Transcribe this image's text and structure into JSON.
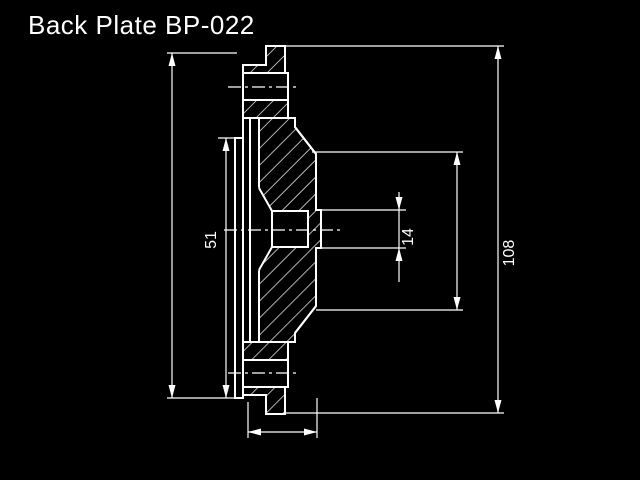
{
  "title": "Back Plate BP-022",
  "labels": {
    "rim_width": "51",
    "boss_diameter": "14",
    "outer_diameter": "108"
  },
  "colors": {
    "background": "#000000",
    "line": "#ffffff"
  }
}
